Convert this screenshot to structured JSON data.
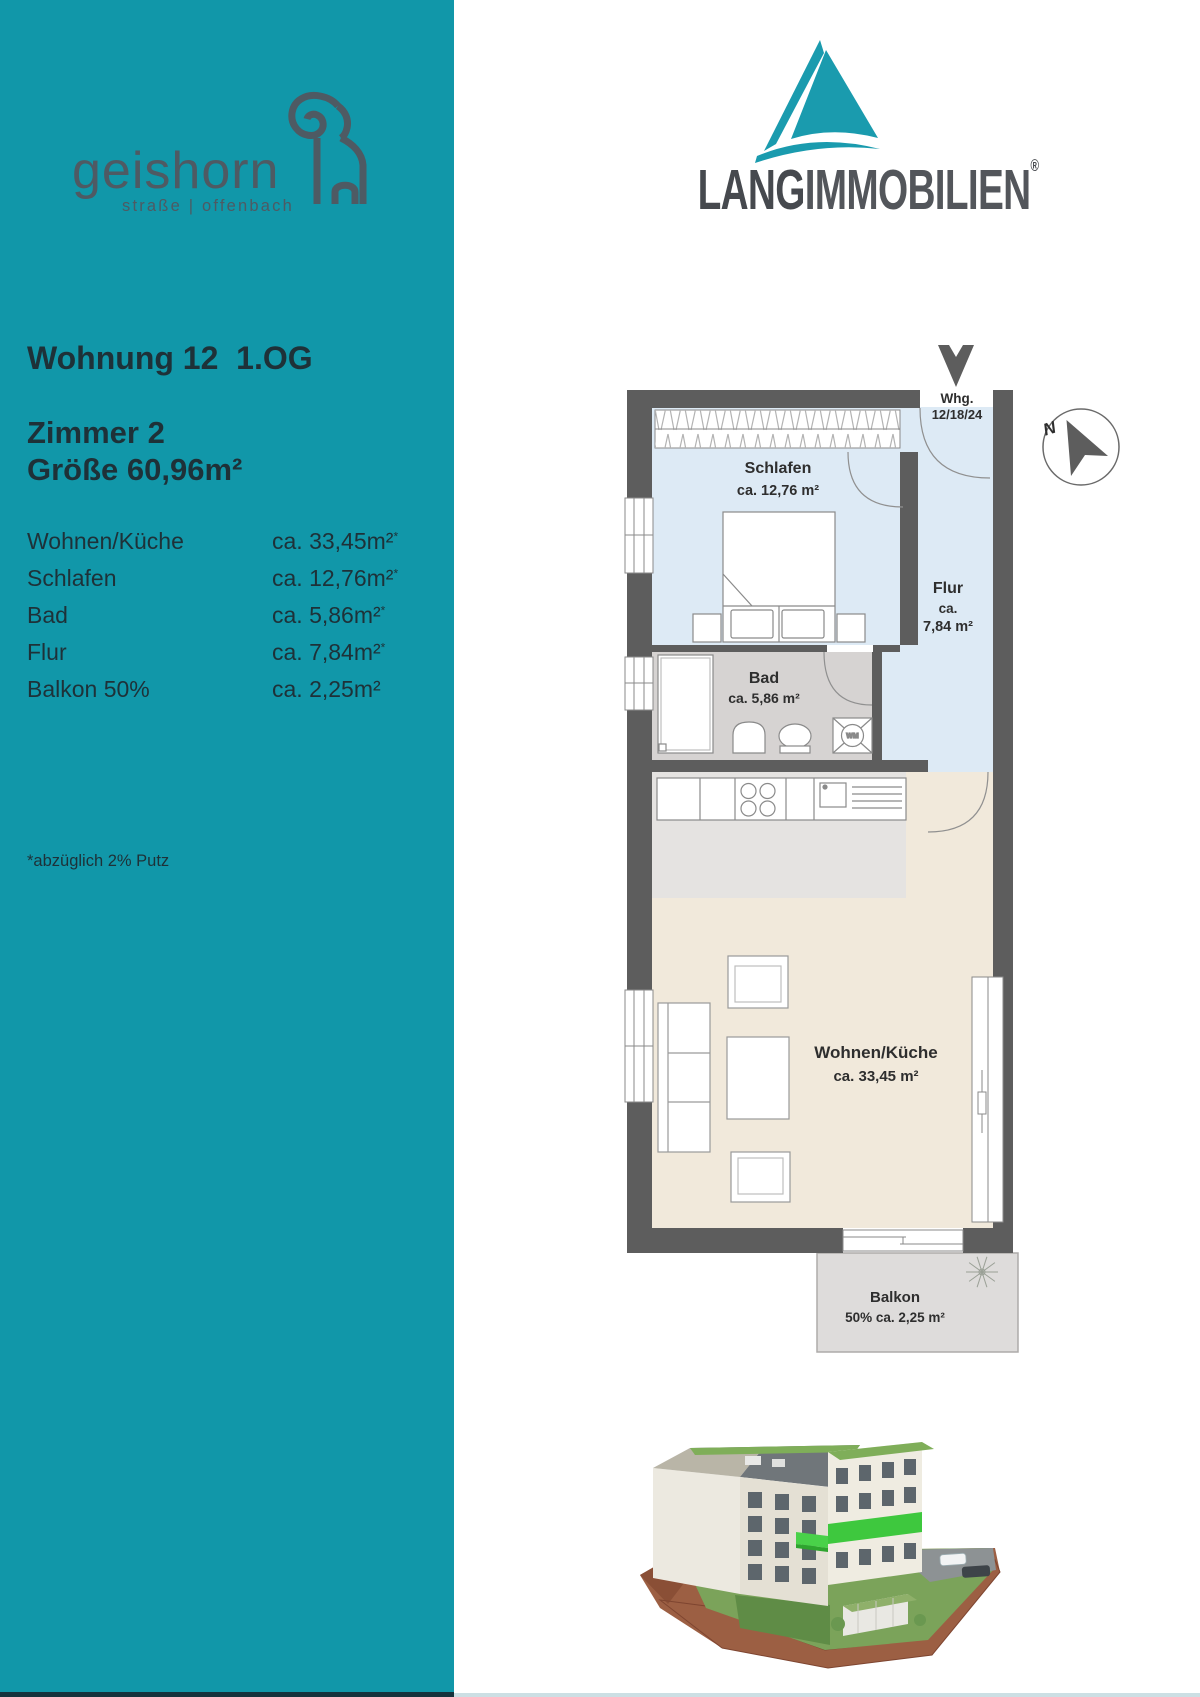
{
  "sidebar": {
    "logo": {
      "name": "geishorn",
      "subtitle": "straße | offenbach"
    },
    "title": "Wohnung 12  1.OG",
    "line1": "Zimmer 2",
    "line2": "Größe 60,96m²",
    "rooms": [
      {
        "label": "Wohnen/Küche",
        "value": "ca. 33,45m²",
        "mark": "*"
      },
      {
        "label": "Schlafen",
        "value": "ca. 12,76m²",
        "mark": "*"
      },
      {
        "label": "Bad",
        "value": "ca. 5,86m²",
        "mark": "*"
      },
      {
        "label": "Flur",
        "value": "ca. 7,84m²",
        "mark": "*"
      },
      {
        "label": "Balkon 50%",
        "value": "ca. 2,25m²",
        "mark": ""
      }
    ],
    "footnote": "*abzüglich 2% Putz"
  },
  "brand": {
    "bold": "LANG",
    "light": "IMMOBILIEN",
    "registered": "®"
  },
  "floorplan": {
    "entrance_label": {
      "line1": "Whg.",
      "line2": "12/18/24"
    },
    "compass": "N",
    "washer_label": "WM",
    "rooms": {
      "schlafen": {
        "name": "Schlafen",
        "area": "ca. 12,76 m²"
      },
      "flur": {
        "name": "Flur",
        "area_line1": "ca.",
        "area_line2": "7,84 m²"
      },
      "bad": {
        "name": "Bad",
        "area": "ca. 5,86 m²"
      },
      "wohnen": {
        "name": "Wohnen/Küche",
        "area": "ca. 33,45 m²"
      },
      "balkon": {
        "name": "Balkon",
        "area": "50% ca. 2,25 m²"
      }
    }
  },
  "colors": {
    "accent_teal": "#1197a9",
    "sidebar_text": "#1e3138",
    "logo_gray": "#4e5a63",
    "wall": "#5d5d5d",
    "floor_blue": "#ddeaf5",
    "floor_bad": "#d6d3d2",
    "floor_kitchen": "#e5e3e1",
    "floor_wohnen": "#f1e9db",
    "floor_balkon": "#dedcdb",
    "brand_text": "#46494e",
    "highlight_green": "#3ec83e"
  }
}
